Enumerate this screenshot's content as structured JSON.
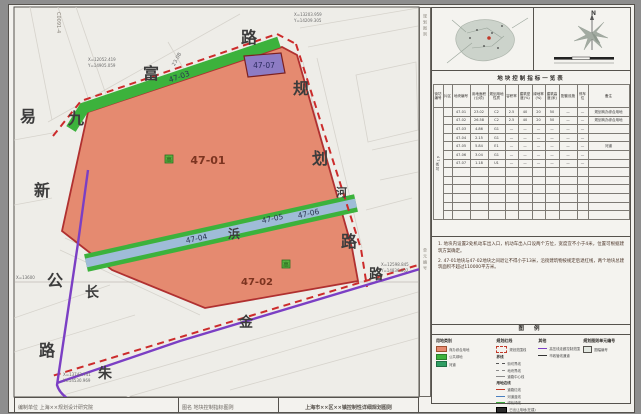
{
  "sheet": {
    "code_vertical": "C0091-4"
  },
  "map": {
    "parcel_labels": [
      {
        "id": "47-01",
        "x": 208,
        "y": 164,
        "size": 11,
        "kind": "main"
      },
      {
        "id": "47-02",
        "x": 257,
        "y": 285,
        "size": 10,
        "kind": "main"
      },
      {
        "id": "47-03",
        "x": 180,
        "y": 79,
        "size": 7.5,
        "rot": -19,
        "kind": "band"
      },
      {
        "id": "47-04",
        "x": 197,
        "y": 241,
        "size": 7.5,
        "rot": -12,
        "kind": "band"
      },
      {
        "id": "47-05",
        "x": 273,
        "y": 221,
        "size": 7.5,
        "rot": -12,
        "kind": "band"
      },
      {
        "id": "47-06",
        "x": 309,
        "y": 216,
        "size": 7.5,
        "rot": -12,
        "kind": "band"
      },
      {
        "id": "47-07",
        "x": 264,
        "y": 68,
        "size": 7.5,
        "kind": "purple"
      }
    ],
    "road_chars": [
      {
        "ch": "易",
        "x": 20,
        "y": 122,
        "size": 16
      },
      {
        "ch": "九",
        "x": 68,
        "y": 124,
        "size": 16
      },
      {
        "ch": "新",
        "x": 34,
        "y": 196,
        "size": 16
      },
      {
        "ch": "公",
        "x": 47,
        "y": 286,
        "size": 16
      },
      {
        "ch": "路",
        "x": 39,
        "y": 356,
        "size": 16
      },
      {
        "ch": "富",
        "x": 143,
        "y": 79,
        "size": 16
      },
      {
        "ch": "路",
        "x": 241,
        "y": 43,
        "size": 16
      },
      {
        "ch": "规",
        "x": 293,
        "y": 94,
        "size": 16
      },
      {
        "ch": "划",
        "x": 312,
        "y": 164,
        "size": 16
      },
      {
        "ch": "路",
        "x": 341,
        "y": 247,
        "size": 16
      },
      {
        "ch": "河",
        "x": 336,
        "y": 196,
        "size": 11
      },
      {
        "ch": "浜",
        "x": 228,
        "y": 238,
        "size": 12
      },
      {
        "ch": "长",
        "x": 85,
        "y": 297,
        "size": 14
      },
      {
        "ch": "朱",
        "x": 98,
        "y": 378,
        "size": 14
      },
      {
        "ch": "金",
        "x": 239,
        "y": 327,
        "size": 14
      },
      {
        "ch": "路",
        "x": 369,
        "y": 279,
        "size": 14
      }
    ],
    "coords": [
      {
        "t": "X=12052.419",
        "x": 88,
        "y": 61
      },
      {
        "t": "Y=14905.059",
        "x": 88,
        "y": 67
      },
      {
        "t": "X=13203.959",
        "x": 294,
        "y": 16
      },
      {
        "t": "Y=14209.305",
        "x": 294,
        "y": 22
      },
      {
        "t": "X=13600",
        "x": 16,
        "y": 279
      },
      {
        "t": "X=13743.741",
        "x": 63,
        "y": 376
      },
      {
        "t": "Y=14530.969",
        "x": 63,
        "y": 382
      },
      {
        "t": "X=12598.845",
        "x": 381,
        "y": 266
      },
      {
        "t": "Y=14836.802",
        "x": 381,
        "y": 272
      }
    ],
    "dim_label": {
      "t": "23.08",
      "x": 178,
      "y": 60,
      "rot": -62
    },
    "marker_char": "高",
    "markers": [
      {
        "x": 165,
        "y": 155
      },
      {
        "x": 282,
        "y": 260
      }
    ]
  },
  "panel": {
    "north_label": "N",
    "strip_top": "规划图则",
    "strip_bottom": "单元编号",
    "table": {
      "title": "地块控制指标一览表",
      "block_label": "47街坊",
      "columns": [
        "街坊编号",
        "片区",
        "地块编号",
        "用地面积(公顷)",
        "规划用地性质",
        "容积率",
        "建筑密度(%)",
        "绿地率(%)",
        "建筑高度(米)",
        "配套设施",
        "停车位",
        "备注"
      ],
      "rows": [
        [
          "",
          "47-01",
          "23.02",
          "C2",
          "2.5",
          "40",
          "20",
          "50",
          "—",
          "—",
          "规划商办综合用地"
        ],
        [
          "",
          "47-02",
          "26.58",
          "C2",
          "2.5",
          "40",
          "20",
          "50",
          "—",
          "—",
          "规划商办综合用地"
        ],
        [
          "",
          "47-03",
          "4.86",
          "G1",
          "—",
          "—",
          "—",
          "—",
          "—",
          "—",
          ""
        ],
        [
          "",
          "47-04",
          "2.15",
          "G1",
          "—",
          "—",
          "—",
          "—",
          "—",
          "—",
          ""
        ],
        [
          "",
          "47-05",
          "5.84",
          "E1",
          "—",
          "—",
          "—",
          "—",
          "—",
          "—",
          "河道"
        ],
        [
          "",
          "47-06",
          "3.04",
          "G1",
          "—",
          "—",
          "—",
          "—",
          "—",
          "—",
          ""
        ],
        [
          "",
          "47-07",
          "1.18",
          "U1",
          "—",
          "—",
          "—",
          "—",
          "—",
          "—",
          ""
        ]
      ],
      "empty_rows": 6
    },
    "notes": {
      "lines": [
        "1. 地块内设置2处机动车出入口，机动车出入口设两个方位，宽度宜不小于4米，位置可根据建筑方案确定。",
        "2. 47-01地块与47-02地块之间退让不得小于13米，沿街建筑物按规定后退红线，两个地块总建筑面积不超过110000平方米。"
      ]
    },
    "legend": {
      "title": "图 例",
      "groups": [
        {
          "title": "用地类别",
          "entries": [
            {
              "g": "swatch-orange",
              "label": "商办综合用地"
            },
            {
              "g": "swatch-green",
              "label": "公共绿地"
            },
            {
              "g": "swatch-teal",
              "label": "河道"
            }
          ]
        },
        {
          "title": "规划红线",
          "entries": [
            {
              "g": "dash-rect",
              "label": "规划范围线"
            },
            {
              "g": "head",
              "label": "界线"
            },
            {
              "g": "line-dashdot",
              "label": "街坊界线"
            },
            {
              "g": "line-dash",
              "label": "地块界线"
            },
            {
              "g": "line-thin",
              "label": "道路中心线"
            },
            {
              "g": "head",
              "label": "用地边线"
            },
            {
              "g": "line-red",
              "label": "道路红线"
            },
            {
              "g": "line-blue",
              "label": "河道蓝线"
            },
            {
              "g": "line-green",
              "label": "绿化绿线"
            },
            {
              "g": "swatch-black",
              "label": "已出让用地(在建)"
            }
          ]
        },
        {
          "title": "其他",
          "entries": [
            {
              "g": "line-purple",
              "label": "高压线走廊控制范围"
            },
            {
              "g": "line-dark",
              "label": "市政管线通道"
            }
          ]
        },
        {
          "title": "规划图则单元编号",
          "entries": [
            {
              "g": "box-small",
              "label": "图幅编号"
            }
          ]
        }
      ]
    },
    "titlebar": [
      "编制单位  上海××规划设计研究院",
      "图名  地块控制指标图则",
      "上海市××区××镇控制性详细规划图则"
    ]
  },
  "colors": {
    "parcel_fill": "#e58a70",
    "parcel_border": "#b03030",
    "green": "#3cb23c",
    "river_blue": "#9fbcd8",
    "purple_parcel": "#8d7cc4",
    "road_purple": "#7b3fc4",
    "red_dash": "#cc2b2b"
  }
}
